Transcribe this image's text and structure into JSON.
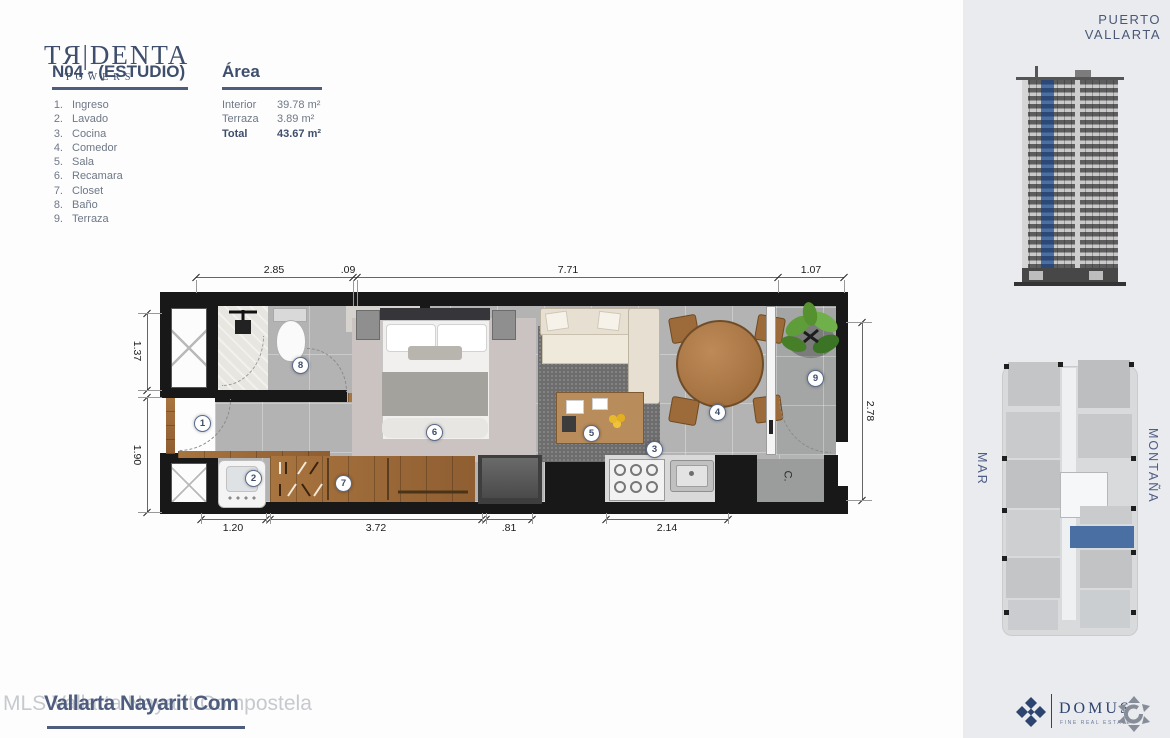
{
  "brand": {
    "name": "TЯ|DENTA",
    "sub": "TOWERS"
  },
  "unit": {
    "title": "N04 - (ESTUDIO)"
  },
  "legend": {
    "items": [
      {
        "n": "1.",
        "label": "Ingreso"
      },
      {
        "n": "2.",
        "label": "Lavado"
      },
      {
        "n": "3.",
        "label": "Cocina"
      },
      {
        "n": "4.",
        "label": "Comedor"
      },
      {
        "n": "5.",
        "label": "Sala"
      },
      {
        "n": "6.",
        "label": "Recamara"
      },
      {
        "n": "7.",
        "label": "Closet"
      },
      {
        "n": "8.",
        "label": "Baño"
      },
      {
        "n": "9.",
        "label": "Terraza"
      }
    ]
  },
  "area": {
    "title": "Área",
    "rows": [
      {
        "label": "Interior",
        "value": "39.78 m²"
      },
      {
        "label": "Terraza",
        "value": "3.89 m²"
      },
      {
        "label": "Total",
        "value": "43.67 m²"
      }
    ]
  },
  "plan": {
    "dims_top": [
      "2.85",
      ".09",
      "7.71",
      "1.07"
    ],
    "dims_bottom": [
      "1.20",
      "3.72",
      ".81",
      "2.14"
    ],
    "dims_left": [
      "1.37",
      "1.90"
    ],
    "dims_right": [
      "2.78"
    ],
    "markers": [
      "1",
      "2",
      "3",
      "4",
      "5",
      "6",
      "7",
      "8",
      "9"
    ],
    "ac_label": "C."
  },
  "sidebar": {
    "location": "PUERTO VALLARTA",
    "orientation_left": "MAR",
    "orientation_right": "MONTAÑA"
  },
  "footer": {
    "watermark_back": "MLS Vallarta Nayarit Compostela",
    "watermark_front": "Vallarta Nayarit Com",
    "domus_name": "DOMUS",
    "domus_tagline": "FINE REAL ESTATE"
  },
  "colors": {
    "navy": "#3e4e6c",
    "accent_blue": "#4a6fa3",
    "highlight_unit": "#4a6fa3"
  }
}
